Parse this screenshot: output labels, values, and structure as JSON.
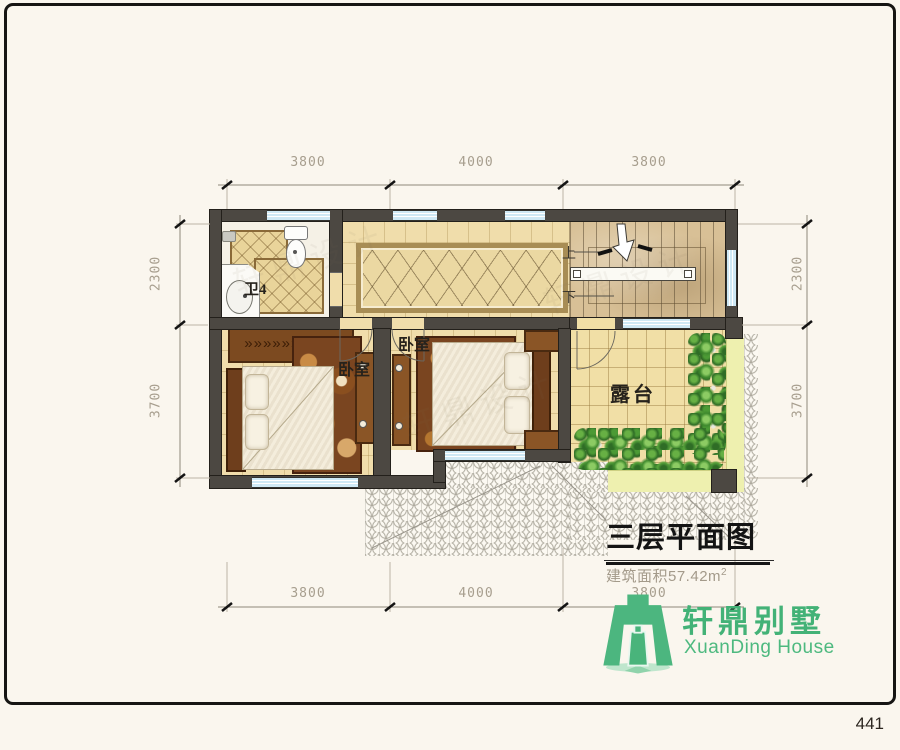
{
  "page": {
    "number": "441"
  },
  "watermark": "轩鼎设计",
  "plan": {
    "rooms": {
      "bathroom": {
        "label": "卫4"
      },
      "bedroom_left": {
        "label": "卧室"
      },
      "bedroom_middle": {
        "label": "卧室"
      },
      "terrace": {
        "label": "露台"
      },
      "stairs": {
        "up": "上",
        "down": "下"
      }
    },
    "dimensions": {
      "top": [
        "3800",
        "4000",
        "3800"
      ],
      "bottom": [
        "3800",
        "4000",
        "3800"
      ],
      "left": [
        "2300",
        "3700"
      ],
      "right": [
        "2300",
        "3700"
      ]
    }
  },
  "title_block": {
    "title": "三层平面图",
    "area_text": "建筑面积57.42m",
    "area_sup": "2"
  },
  "logo": {
    "cn": "轩鼎别墅",
    "en": "XuanDing House"
  },
  "colors": {
    "wall": "#4c4842",
    "window_blue": "#cfe9f5",
    "floor_tan": "#f0ddab",
    "logo_green": "#43b277",
    "terrace_band": "#eef0af",
    "title_text": "#141414"
  }
}
